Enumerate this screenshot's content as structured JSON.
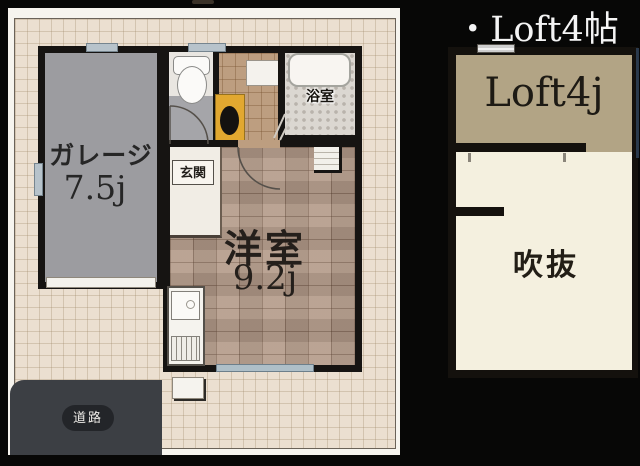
{
  "plan": {
    "garage": {
      "label": "ガレージ",
      "size": "7.5j"
    },
    "entrance": {
      "label": "玄関"
    },
    "bathroom": {
      "label": "浴室"
    },
    "main_room": {
      "label": "洋室",
      "size": "9.2j"
    },
    "road": {
      "label": "道路"
    }
  },
  "loft_panel": {
    "title": "・Loft4帖",
    "loft": {
      "label": "Loft4j"
    },
    "void": {
      "label": "吹抜"
    }
  },
  "colors": {
    "wall": "#161412",
    "ground_beige": "#ebdfd0",
    "garage_floor_gray": "#9c9ca0",
    "room_tile_brown": "#b49b8a",
    "hall_tile_brown": "#bd9e80",
    "washbasin_yellow": "#e2a830",
    "window_blue": "#aebfc8",
    "road_gray": "#3c3f44",
    "loft_tan": "#b2a485",
    "void_cream": "#f4f0df",
    "title_white": "#f4f4f4"
  }
}
